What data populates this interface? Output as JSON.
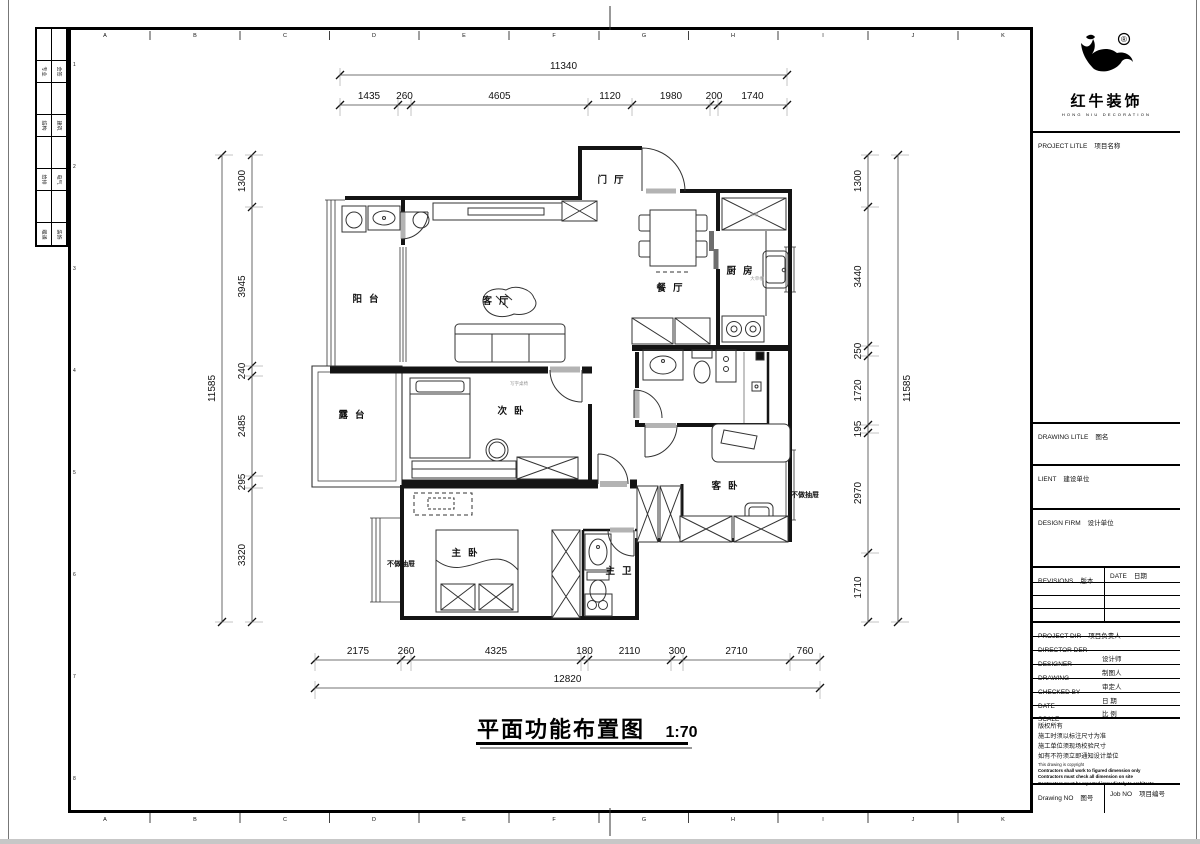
{
  "sheet": {
    "grid_letters": [
      "A",
      "B",
      "C",
      "D",
      "E",
      "F",
      "G",
      "H",
      "I",
      "J",
      "K"
    ],
    "grid_numbers": [
      "1",
      "2",
      "3",
      "4",
      "5",
      "6",
      "7",
      "8"
    ],
    "signoff_rows": [
      [
        "专业",
        "会签"
      ],
      [
        "结构",
        "建筑"
      ],
      [
        "给排",
        "电气"
      ],
      [
        "暖通",
        "装饰"
      ]
    ]
  },
  "title": {
    "text": "平面功能布置图",
    "scale": "1:70"
  },
  "dimensions": {
    "top": {
      "total": "11340",
      "segments": [
        "1435",
        "260",
        "4605",
        "1120",
        "1980",
        "200",
        "1740"
      ]
    },
    "bottom": {
      "total": "12820",
      "segments": [
        "2175",
        "260",
        "4325",
        "180",
        "2110",
        "300",
        "2710",
        "760"
      ]
    },
    "left": {
      "total": "11585",
      "segments": [
        "1300",
        "3945",
        "240",
        "2485",
        "295",
        "3320"
      ]
    },
    "right": {
      "total": "11585",
      "segments": [
        "1300",
        "3440",
        "250",
        "1720",
        "195",
        "2970",
        "1710"
      ]
    }
  },
  "plan": {
    "rooms": [
      {
        "id": "entry",
        "label": "门厅"
      },
      {
        "id": "balcony",
        "label": "阳台"
      },
      {
        "id": "living",
        "label": "客厅"
      },
      {
        "id": "dining",
        "label": "餐厅"
      },
      {
        "id": "kitchen",
        "label": "厨房"
      },
      {
        "id": "terrace",
        "label": "露台"
      },
      {
        "id": "bedroom2",
        "label": "次卧"
      },
      {
        "id": "guest",
        "label": "客卧"
      },
      {
        "id": "master",
        "label": "主卧"
      },
      {
        "id": "masterbath",
        "label": "主卫"
      }
    ],
    "notes": [
      {
        "id": "no-drawer-left",
        "label": "不做抽屉"
      },
      {
        "id": "no-drawer-right",
        "label": "不做抽屉"
      }
    ],
    "annotations": [
      {
        "id": "desk",
        "label": "写字桌椅"
      },
      {
        "id": "fridge",
        "label": "冰箱"
      },
      {
        "id": "kitchen-sink",
        "label": "大单槽"
      }
    ]
  },
  "titleblock": {
    "logo": {
      "brand": "红牛装饰",
      "sub": "HONG NIU DECORATION",
      "reg": "®"
    },
    "fields": [
      {
        "id": "project-title",
        "en": "PROJECT LITLE",
        "cn": "项目名称"
      },
      {
        "id": "drawing-title",
        "en": "DRAWING LITLE",
        "cn": "图名"
      },
      {
        "id": "client",
        "en": "LIENT",
        "cn": "建设单位"
      },
      {
        "id": "design-firm",
        "en": "DESIGN FIRM",
        "cn": "设计单位"
      },
      {
        "id": "revisions",
        "en": "REVISIONS",
        "cn": "版本"
      },
      {
        "id": "date-col",
        "en": "DATE",
        "cn": "日期"
      },
      {
        "id": "project-dir",
        "en": "PROJECT DIR",
        "cn": "项目负责人"
      },
      {
        "id": "director",
        "en": "DIRECTOR DER",
        "cn": ""
      },
      {
        "id": "designer",
        "en": "DESIGNER",
        "cn": "设计师"
      },
      {
        "id": "drawing-by",
        "en": "DRAWING",
        "cn": "制图人"
      },
      {
        "id": "checked-by",
        "en": "CHECKED BY",
        "cn": "审定人"
      },
      {
        "id": "date",
        "en": "DATE",
        "cn": "日  期"
      },
      {
        "id": "scale",
        "en": "SCALE",
        "cn": "比  例"
      },
      {
        "id": "drawing-no",
        "en": "Drawing NO",
        "cn": "图号"
      },
      {
        "id": "job-no",
        "en": "Job NO",
        "cn": "项目编号"
      }
    ],
    "notes_cn": [
      "版权所有",
      "施工时须以标注尺寸为准",
      "施工单位须现场校验尺寸",
      "如有不符须立即通知设计单位"
    ],
    "notes_en_normal": "This drawing is copyright",
    "notes_en_bold": [
      "Contractors shall work to figured dimension only",
      "Contractors must check all dimension on site",
      "Contractors must be reported immediately to architects"
    ]
  }
}
